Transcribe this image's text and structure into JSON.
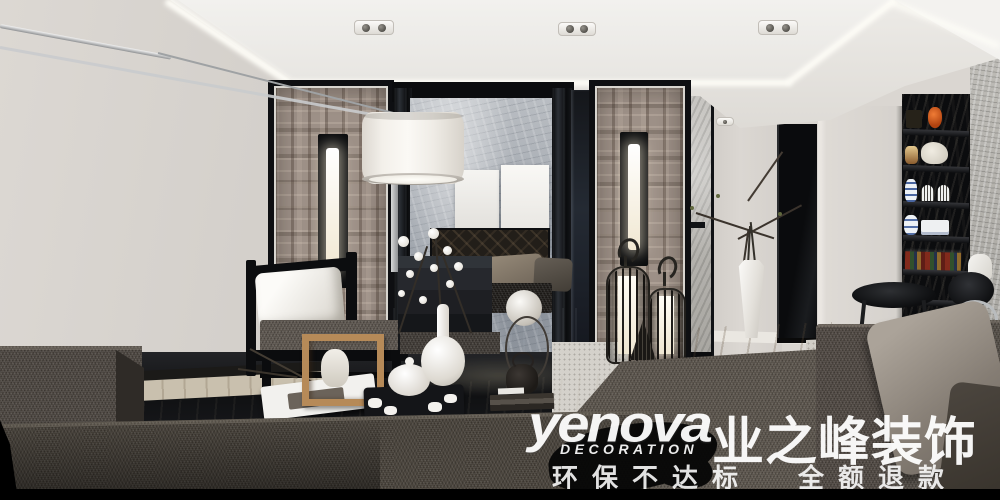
{
  "watermark": {
    "brand": "yenova",
    "brand_sub": "DECORATION",
    "brand_cn": "业之峰装饰",
    "slogan_left": "环保不达标",
    "slogan_right": "全额退款",
    "text_color": "#ffffff"
  },
  "palette": {
    "wall_gray": "#d6d2cd",
    "ceiling_white": "#f1f0ed",
    "cove_glow": "#fffef8",
    "plaid_taupe": "#9d9087",
    "marble_gray": "#a7adb4",
    "frame_black": "#0e0f12",
    "sofa_brown_gray": "#554e47",
    "wood_floor": "#c8beac",
    "accent_orange": "#d8602a",
    "porcelain_blue": "#4a66a0",
    "warm_glow": "#f6ecd0"
  },
  "scene": {
    "type": "interior-render",
    "room": "living-room-new-chinese-style"
  }
}
